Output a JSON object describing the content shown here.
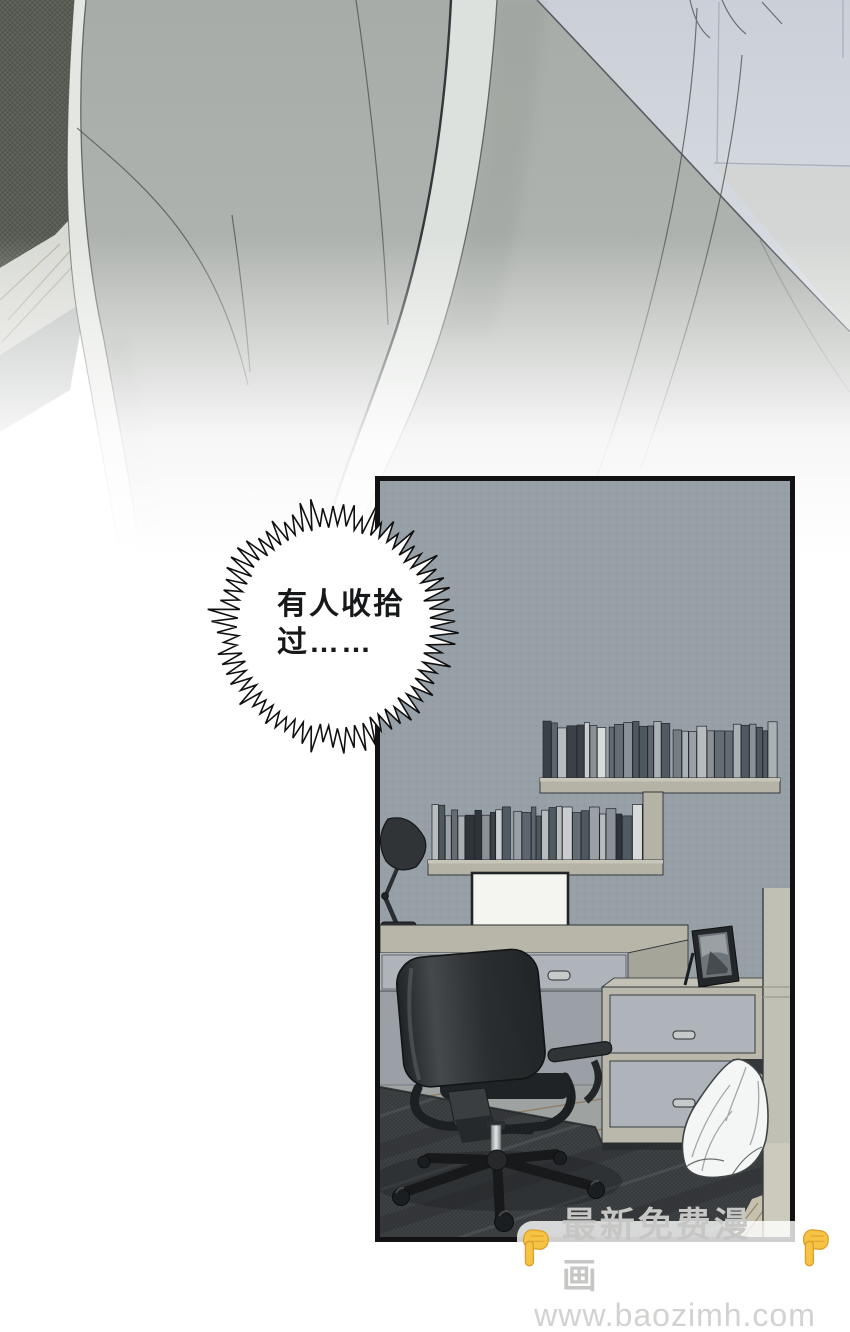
{
  "speech_bubble": {
    "line1": "有人收拾",
    "line2": "过……"
  },
  "watermark": {
    "title": "最新免费漫画",
    "url": "www.baozimh.com"
  },
  "icons": {
    "left_hand": "pointing-down-hand",
    "right_hand": "pointing-down-hand"
  },
  "colors": {
    "panel_border": "#121214",
    "panel_wall": "#979fa7",
    "shelf_face": "#b4b3a5",
    "shelf_top": "#c7c6b8",
    "desk_face": "#aeb4b9",
    "desk_top": "#b7b6a9",
    "cabinet_frame": "#b9b8ab",
    "chair_dark": "#26292b",
    "chair_mid": "#3c4043",
    "rug": "#3f4244",
    "wood": "#9ea3a1",
    "wood_line": "#8a7152",
    "cloth": "#f4f6f5",
    "figure": "#a7aca8",
    "figure_edge": "#e3e6e1",
    "strap": "#dde1dd",
    "couch": "#60635a",
    "wall_tr": "#cbd0d8",
    "ink": "#1c1f22",
    "hand": "#f6c445",
    "hand_shade": "#dd9f2b",
    "watermark_text": "#c6c6c4",
    "watermark_url": "#d2d2d0",
    "watermark_bg": "rgba(255,255,255,0.80)"
  }
}
